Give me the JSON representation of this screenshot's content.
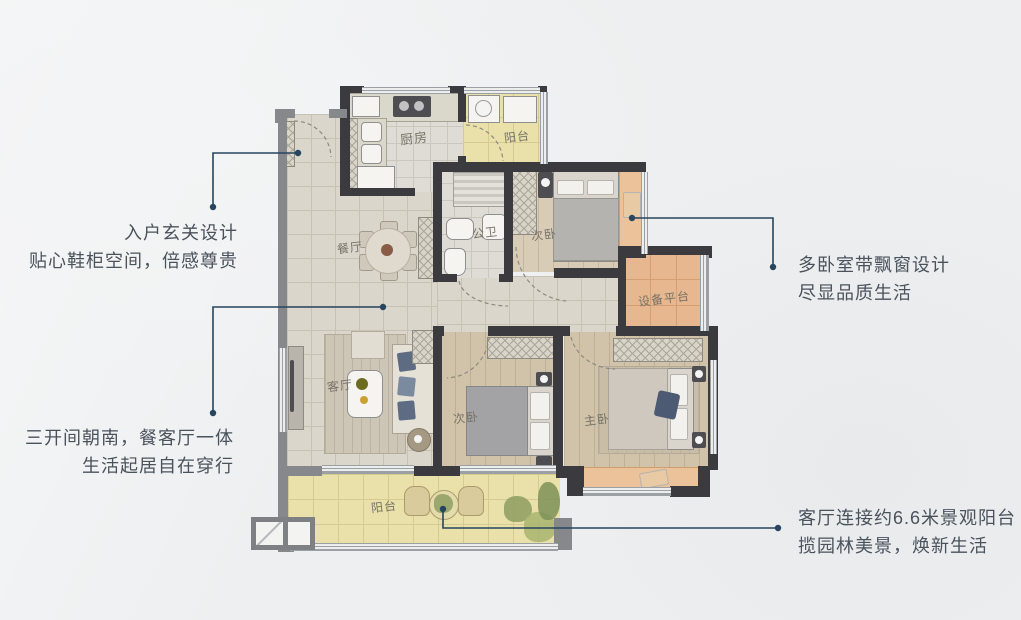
{
  "title": "residential-floor-plan",
  "colors": {
    "wall_dark": "#3b3b3f",
    "wall_gray": "#87888c",
    "leader_line": "#27455e",
    "annotation_text": "#4a525c",
    "balcony_floor": "#e9e0aa",
    "bay_window": "#ecc29b",
    "tile_floor": "#dbd6cb",
    "wood_floor": "#d1c3aa"
  },
  "annotations": {
    "entry": {
      "line1": "入户玄关设计",
      "line2": "贴心鞋柜空间，倍感尊贵"
    },
    "living": {
      "line1": "三开间朝南，餐客厅一体",
      "line2": "生活起居自在穿行"
    },
    "bedroom": {
      "line1": "多卧室带飘窗设计",
      "line2": "尽显品质生活"
    },
    "balcony": {
      "line1": "客厅连接约6.6米景观阳台",
      "line2": "揽园林美景，焕新生活"
    }
  },
  "rooms": {
    "kitchen": {
      "label": "厨房"
    },
    "balcony_top": {
      "label": "阳台"
    },
    "bathroom": {
      "label": "公卫"
    },
    "bedroom_top": {
      "label": "次卧"
    },
    "equipment_platform": {
      "label": "设备平台"
    },
    "dining": {
      "label": "餐厅"
    },
    "living": {
      "label": "客厅"
    },
    "bedroom_middle": {
      "label": "次卧"
    },
    "master_bedroom": {
      "label": "主卧"
    },
    "balcony_bottom": {
      "label": "阳台"
    }
  }
}
